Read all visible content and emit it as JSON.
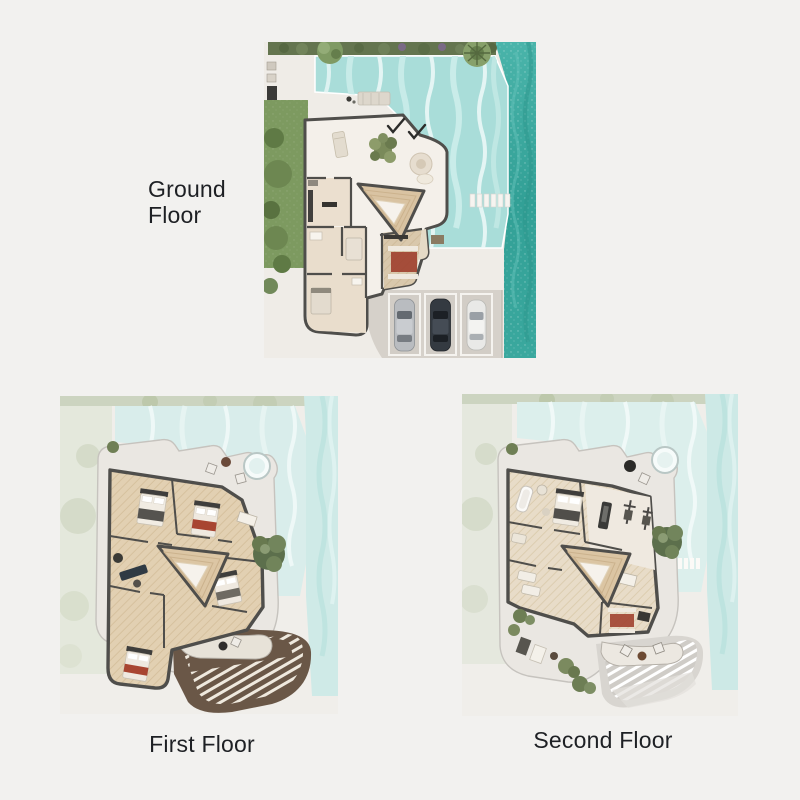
{
  "page": {
    "background": "#f2f1ef"
  },
  "floors": [
    {
      "id": "ground",
      "label": "Ground Floor"
    },
    {
      "id": "first",
      "label": "First Floor"
    },
    {
      "id": "second",
      "label": "Second Floor"
    }
  ],
  "palette": {
    "sea": "#37a79d",
    "pool": "#a9ddd9",
    "pool_faded": "#d9edea",
    "lawn": "#7d9a60",
    "hedge": "#64754f",
    "wall": "#4f4e4b",
    "marble_floor": "#f4f0ea",
    "wood_floor": "#e3d1b3",
    "stair": "#d9c3a2",
    "rug_red": "#9e3f2d",
    "pergola_brown": "#6a5747",
    "pergola_gray": "#d8d5d0",
    "car_silver": "#b9bcc0",
    "car_dark": "#343a41",
    "car_white": "#e9e9e7",
    "label_text": "#1e2024"
  }
}
